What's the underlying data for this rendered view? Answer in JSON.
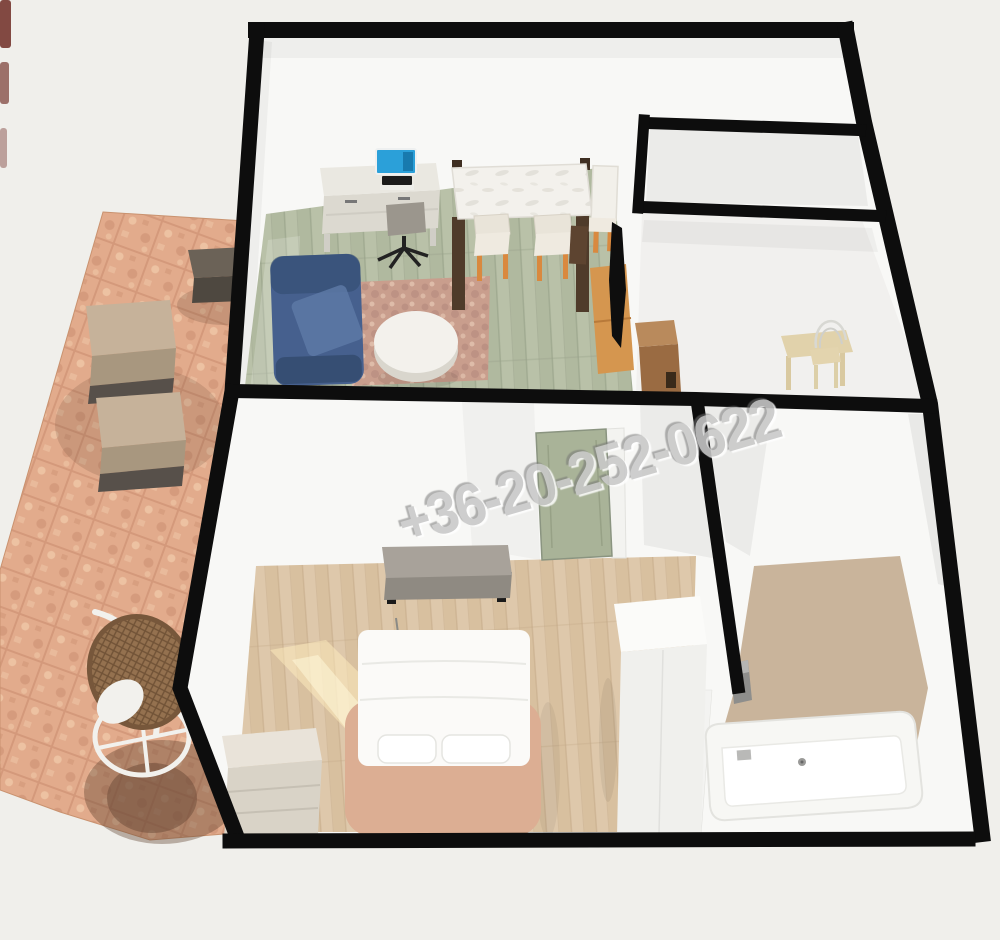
{
  "scene": {
    "type": "3d-floorplan-render",
    "watermark": {
      "text": "+36-20-252-0622"
    }
  },
  "colors": {
    "background": "#f0efeb",
    "wall": "#0d0d0d",
    "room": "#f8f8f6",
    "hall_floor": "#f1f0ee",
    "niche_floor": "#ebebe9",
    "living_floor": "#b9c1a8",
    "living_streak": "#a9b296",
    "oak_floor": "#dec8ab",
    "oak_streak": "#d2b893",
    "bath_floor": "#c9b49b",
    "terrace": "#e2ab8c",
    "terrace_dark": "#c5886a",
    "terrace_light": "#f0c9a9",
    "shadow": "rgba(92,62,44,0.38)",
    "sofa": "#46608e",
    "sofa_light": "#5d79a6",
    "sofa_dark": "#324a6d",
    "rug": "#c99e8d",
    "rug_dark": "#b0837a",
    "desk": "#eae8e1",
    "desk_front": "#dcd9d0",
    "monitor_screen": "#2ba0d9",
    "keyboard": "#1c1c1c",
    "chair_gray": "#9b968d",
    "table_white": "#f3f1ec",
    "table_leg": "#4f3b2a",
    "chair_cream": "#e9e4d9",
    "chair_leg_orange": "#d9893f",
    "tv": "#0e0e0e",
    "tv_stand": "#d5964f",
    "wall_shelf": "#5d4430",
    "hall_cabinet": "#9a6b42",
    "hall_cabinet_top": "#b98a5c",
    "wood_desk": "#e1d2ab",
    "wire_chair": "#d8d8d3",
    "door_green": "#a9b398",
    "door_frame": "#f3f3f0",
    "bench": "#a8a29a",
    "bench_front": "#8f8a82",
    "bed_frame": "#dcae93",
    "bedding": "#fbfaf8",
    "pillow": "#ffffff",
    "wardrobe": "#f0f0ed",
    "wardrobe_top": "#fbfbf9",
    "dresser": "#e9e3d9",
    "dresser_front": "#d9d3c7",
    "tub": "#f7f7f4",
    "tub_inner": "#ffffff",
    "fixture_gray": "#8e8e8c",
    "outdoor_cushion": "#c6b29a",
    "outdoor_cushion_front": "#a8977f",
    "outdoor_dark": "#57504a",
    "outdoor_table": "#6b6257",
    "outdoor_table_front": "#4e4840",
    "rattan": "#94714f",
    "rattan_rim": "#77573b",
    "stand_white": "#f2f1ed",
    "sunlight": "#ffeec0",
    "artifact_red": "#6e2b24",
    "watermark": "#c9c9c9"
  }
}
